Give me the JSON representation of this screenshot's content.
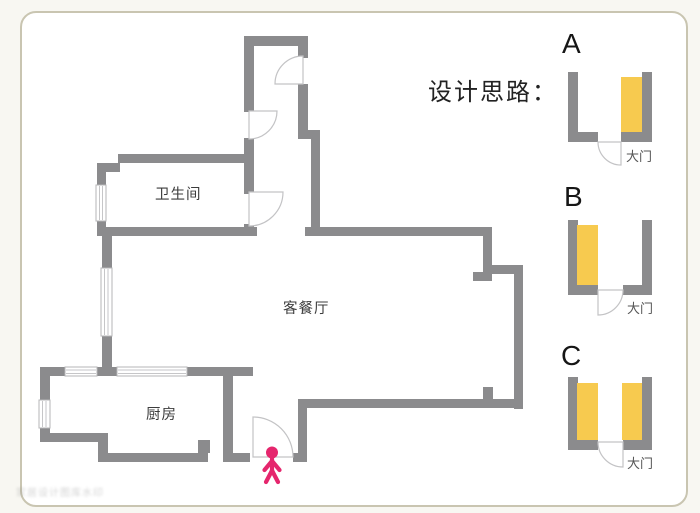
{
  "heading": {
    "text": "设计思路："
  },
  "floorplan": {
    "rooms": [
      {
        "name": "bathroom",
        "label": "卫生间"
      },
      {
        "name": "living-dining",
        "label": "客餐厅"
      },
      {
        "name": "kitchen",
        "label": "厨房"
      }
    ]
  },
  "options": [
    {
      "letter": "A",
      "door_label": "大门",
      "cabinet_sides": [
        "right"
      ]
    },
    {
      "letter": "B",
      "door_label": "大门",
      "cabinet_sides": [
        "left"
      ]
    },
    {
      "letter": "C",
      "door_label": "大门",
      "cabinet_sides": [
        "left",
        "right"
      ]
    }
  ],
  "watermark": {
    "text": "家居设计图库水印"
  },
  "colors": {
    "wall": "#8b8b8d",
    "accent": "#f7ca4f",
    "person": "#e5266d",
    "ink": "#222222",
    "label": "#3c3c3c",
    "muted": "#555555",
    "frame": "#c9c5b1",
    "page": "#f8f7f2"
  }
}
